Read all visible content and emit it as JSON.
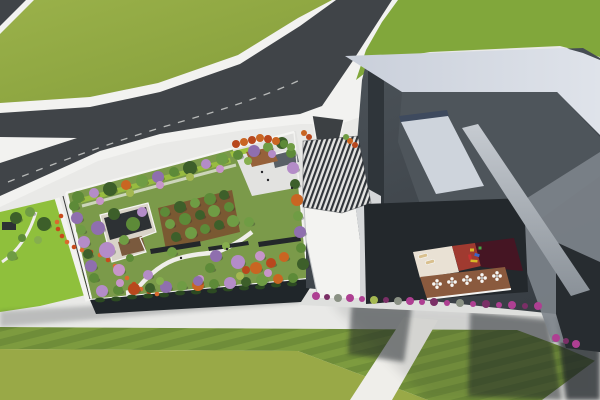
{
  "colors": {
    "pavement": "#e9e9e7",
    "sidewalk": "#f2f2f0",
    "walkway": "#dedfdd",
    "grassA1": "#9ab14a",
    "grassA2": "#849d3a",
    "grassB": "#81a73b",
    "limeLawn": "#8fc03c",
    "gardenLawn": "#7b9a4a",
    "plazaDeck": "#e2e2e0",
    "hedge": "#9ec23e",
    "stripeA": "#7d9b3f",
    "stripeB": "#6f8d39",
    "plainGrass": "#99a947",
    "pathWhite": "#efeeea",
    "road": "#404448",
    "roadLine": "#dfe0de",
    "driveway": "#3c4043",
    "facadeDark": "#20262a",
    "shrubDark": "#2c4a22",
    "parapet": "#f5f5f3",
    "bldgBase1": "#4d545a",
    "bldgBase2": "#383e44",
    "roofBand": "#c9cfda",
    "roofBandLight": "#dfe3ea",
    "darkWall": "#2f353a",
    "innerBowl": "#4e555b",
    "skylight": "#ced4dc",
    "skylightEdge": "#3e4a5e",
    "skylight2": "#9aa1a8",
    "facet": "#7d848b",
    "fin1": "#c6cbd1",
    "fin2": "#8a9198",
    "whiteBldg": "#f3f3f1",
    "slab": "#d5d7d9",
    "slabEdge": "#bfc2c4",
    "canopyLight": "#e3e3e1",
    "canopyDark": "#2f3338",
    "kiosk": "#596067",
    "wedgeBrown": "#96613a",
    "grove": "#7a5230",
    "deckDark": "#2d3134",
    "deckWood": "#7a5a3e",
    "deckPale": "#d9d4c8",
    "bench": "#23272a",
    "notchShade": "#23282c",
    "terraceCream": "#e9e1d4",
    "terraceRed": "#a03a30",
    "terraceMaroon": "#451523",
    "terraceBrown": "#8a5a3e",
    "beige": "#d9c08e",
    "tableWhite": "#f7f7f5",
    "tableCenter": "#b9b9b7",
    "shadow": "#1c2126",
    "darkFoot": "#272c30",
    "ribbon": "#c84a1c",
    "ribbon2": "#d96a2e",
    "person": "#26262a",
    "g1": "#3d5f2a",
    "g2": "#5d8a38",
    "g3": "#6f9c44",
    "g4": "#86ae4e",
    "p1": "#8f6fae",
    "p2": "#b48cc8",
    "p3": "#c795c9",
    "o1": "#c96522",
    "o2": "#b8481d",
    "y1": "#a4b851",
    "m1": "#ae3f92",
    "m2": "#7a2f66",
    "s1": "#8a9184",
    "py": "#d8b828",
    "pb": "#3a66c8",
    "pr": "#c83232",
    "pg": "#48a848"
  },
  "scene": {
    "trees": [
      [
        78,
        197,
        6,
        "g2"
      ],
      [
        94,
        193,
        5,
        "p2"
      ],
      [
        110,
        189,
        7,
        "g1"
      ],
      [
        126,
        185,
        5,
        "o1"
      ],
      [
        142,
        181,
        6,
        "g3"
      ],
      [
        158,
        177,
        6,
        "p1"
      ],
      [
        174,
        172,
        5,
        "g2"
      ],
      [
        190,
        168,
        7,
        "g1"
      ],
      [
        206,
        164,
        5,
        "p2"
      ],
      [
        222,
        159,
        6,
        "g3"
      ],
      [
        238,
        155,
        5,
        "g2"
      ],
      [
        254,
        151,
        6,
        "p1"
      ],
      [
        268,
        147,
        5,
        "g3"
      ],
      [
        282,
        143,
        6,
        "g1"
      ],
      [
        100,
        201,
        4,
        "p3"
      ],
      [
        130,
        193,
        4,
        "y1"
      ],
      [
        160,
        185,
        4,
        "p3"
      ],
      [
        190,
        177,
        4,
        "y1"
      ],
      [
        220,
        169,
        4,
        "p3"
      ],
      [
        248,
        161,
        4,
        "g4"
      ],
      [
        272,
        154,
        4,
        "p2"
      ],
      [
        291,
        153,
        5,
        "g2"
      ],
      [
        293,
        168,
        6,
        "p2"
      ],
      [
        295,
        184,
        5,
        "g1"
      ],
      [
        297,
        200,
        6,
        "o1"
      ],
      [
        298,
        216,
        5,
        "g3"
      ],
      [
        300,
        232,
        6,
        "p1"
      ],
      [
        301,
        248,
        5,
        "g2"
      ],
      [
        303,
        264,
        6,
        "g1"
      ],
      [
        102,
        291,
        6,
        "p2"
      ],
      [
        118,
        290,
        5,
        "g2"
      ],
      [
        134,
        289,
        6,
        "o2"
      ],
      [
        150,
        288,
        5,
        "g1"
      ],
      [
        166,
        287,
        6,
        "p1"
      ],
      [
        182,
        286,
        5,
        "g3"
      ],
      [
        198,
        285,
        6,
        "o1"
      ],
      [
        214,
        284,
        5,
        "g2"
      ],
      [
        230,
        283,
        6,
        "p2"
      ],
      [
        246,
        282,
        5,
        "g1"
      ],
      [
        262,
        280,
        6,
        "g3"
      ],
      [
        278,
        279,
        5,
        "o1"
      ],
      [
        293,
        278,
        5,
        "g2"
      ],
      [
        120,
        283,
        4,
        "p3"
      ],
      [
        160,
        281,
        4,
        "g4"
      ],
      [
        200,
        279,
        4,
        "p3"
      ],
      [
        240,
        276,
        4,
        "y1"
      ],
      [
        268,
        273,
        4,
        "p3"
      ],
      [
        74,
        206,
        5,
        "g2"
      ],
      [
        77,
        218,
        6,
        "p1"
      ],
      [
        81,
        230,
        5,
        "g3"
      ],
      [
        84,
        242,
        6,
        "p2"
      ],
      [
        88,
        254,
        5,
        "g1"
      ],
      [
        91,
        266,
        6,
        "p1"
      ],
      [
        94,
        278,
        5,
        "g2"
      ],
      [
        98,
        228,
        7,
        "p1"
      ],
      [
        107,
        250,
        8,
        "p2"
      ],
      [
        119,
        270,
        6,
        "p3"
      ],
      [
        148,
        275,
        5,
        "p2"
      ],
      [
        216,
        256,
        6,
        "p1"
      ],
      [
        238,
        262,
        7,
        "p2"
      ],
      [
        260,
        256,
        5,
        "p3"
      ],
      [
        198,
        281,
        5,
        "p1"
      ],
      [
        256,
        268,
        6,
        "o1"
      ],
      [
        271,
        263,
        5,
        "o2"
      ],
      [
        284,
        257,
        5,
        "o1"
      ],
      [
        246,
        270,
        4,
        "o2"
      ],
      [
        172,
        252,
        5,
        "g3"
      ],
      [
        210,
        268,
        5,
        "g2"
      ],
      [
        226,
        246,
        4,
        "g4"
      ],
      [
        130,
        258,
        4,
        "g2"
      ],
      [
        249,
        222,
        5,
        "g3"
      ],
      [
        165,
        212,
        5,
        "g2"
      ],
      [
        180,
        207,
        6,
        "g1"
      ],
      [
        195,
        203,
        5,
        "g3"
      ],
      [
        210,
        199,
        6,
        "g2"
      ],
      [
        224,
        195,
        5,
        "g1"
      ],
      [
        170,
        224,
        5,
        "g3"
      ],
      [
        185,
        219,
        6,
        "g2"
      ],
      [
        200,
        215,
        5,
        "g1"
      ],
      [
        214,
        211,
        6,
        "g3"
      ],
      [
        229,
        207,
        5,
        "g2"
      ],
      [
        176,
        237,
        5,
        "g1"
      ],
      [
        191,
        233,
        6,
        "g3"
      ],
      [
        205,
        229,
        5,
        "g2"
      ],
      [
        219,
        225,
        5,
        "g1"
      ],
      [
        233,
        221,
        6,
        "g3"
      ],
      [
        114,
        214,
        6,
        "g1"
      ],
      [
        133,
        224,
        7,
        "g2"
      ],
      [
        124,
        240,
        5,
        "g3"
      ],
      [
        142,
        212,
        5,
        "p2"
      ],
      [
        236,
        144,
        4,
        "o2"
      ],
      [
        244,
        142,
        4,
        "o1"
      ],
      [
        252,
        140,
        4,
        "o2"
      ],
      [
        260,
        138,
        4,
        "o1"
      ],
      [
        268,
        139,
        4,
        "o2"
      ],
      [
        276,
        141,
        4,
        "o1"
      ],
      [
        284,
        144,
        4,
        "g2"
      ],
      [
        291,
        147,
        4,
        "g3"
      ],
      [
        16,
        218,
        6,
        "g1"
      ],
      [
        30,
        212,
        5,
        "g3"
      ],
      [
        44,
        224,
        7,
        "g1"
      ],
      [
        22,
        238,
        4,
        "g2"
      ],
      [
        12,
        256,
        5,
        "g3"
      ],
      [
        38,
        240,
        4,
        "g4"
      ],
      [
        304,
        133,
        3,
        "o1"
      ],
      [
        309,
        137,
        3,
        "o2"
      ],
      [
        350,
        141,
        3,
        "o1"
      ],
      [
        355,
        145,
        3,
        "o2"
      ],
      [
        346,
        137,
        3,
        "g3"
      ]
    ],
    "bushes": [
      [
        316,
        296,
        4,
        "m1"
      ],
      [
        327,
        297,
        3,
        "m2"
      ],
      [
        338,
        298,
        4,
        "s1"
      ],
      [
        350,
        298,
        4,
        "m1"
      ],
      [
        362,
        299,
        3,
        "m1"
      ],
      [
        374,
        300,
        4,
        "y1"
      ],
      [
        386,
        300,
        3,
        "m2"
      ],
      [
        398,
        301,
        4,
        "s1"
      ],
      [
        410,
        301,
        4,
        "m1"
      ],
      [
        422,
        302,
        3,
        "m1"
      ],
      [
        434,
        302,
        4,
        "m2"
      ],
      [
        447,
        303,
        3,
        "m1"
      ],
      [
        460,
        303,
        4,
        "s1"
      ],
      [
        473,
        304,
        3,
        "m1"
      ],
      [
        486,
        304,
        4,
        "m2"
      ],
      [
        499,
        305,
        3,
        "m1"
      ],
      [
        512,
        305,
        4,
        "m1"
      ],
      [
        525,
        306,
        3,
        "m2"
      ],
      [
        538,
        306,
        4,
        "m1"
      ],
      [
        556,
        338,
        4,
        "m1"
      ],
      [
        566,
        341,
        3,
        "m2"
      ],
      [
        576,
        344,
        4,
        "m1"
      ]
    ],
    "facade_shrubs": [
      [
        100,
        300
      ],
      [
        116,
        299
      ],
      [
        132,
        297
      ],
      [
        148,
        296
      ],
      [
        164,
        295
      ],
      [
        180,
        293
      ],
      [
        196,
        292
      ],
      [
        212,
        291
      ],
      [
        228,
        289
      ],
      [
        244,
        288
      ],
      [
        260,
        287
      ],
      [
        276,
        285
      ],
      [
        292,
        284
      ]
    ],
    "ribbon_flowers": [
      [
        62,
        236
      ],
      [
        67,
        242
      ],
      [
        74,
        247
      ],
      [
        82,
        250
      ],
      [
        91,
        252
      ],
      [
        100,
        255
      ],
      [
        108,
        260
      ],
      [
        115,
        266
      ],
      [
        121,
        272
      ],
      [
        127,
        278
      ],
      [
        134,
        284
      ],
      [
        141,
        289
      ],
      [
        149,
        292
      ],
      [
        157,
        294
      ],
      [
        58,
        229
      ],
      [
        57,
        222
      ],
      [
        61,
        216
      ]
    ],
    "tables": [
      [
        437,
        284
      ],
      [
        452,
        282
      ],
      [
        467,
        280
      ],
      [
        482,
        278
      ],
      [
        497,
        276
      ]
    ],
    "loungers": [
      [
        423,
        256,
        -15
      ],
      [
        430,
        262,
        -15
      ]
    ],
    "playground": [
      [
        472,
        250,
        4,
        3,
        0,
        "py"
      ],
      [
        477,
        255,
        5,
        3,
        15,
        "pb"
      ],
      [
        470,
        257,
        3,
        5,
        -10,
        "pr"
      ],
      [
        480,
        248,
        3,
        3,
        0,
        "pg"
      ],
      [
        474,
        261,
        7,
        2.5,
        5,
        "py"
      ]
    ],
    "people": [
      [
        262,
        172
      ],
      [
        268,
        180
      ],
      [
        181,
        258
      ],
      [
        227,
        249
      ],
      [
        292,
        188
      ]
    ]
  }
}
